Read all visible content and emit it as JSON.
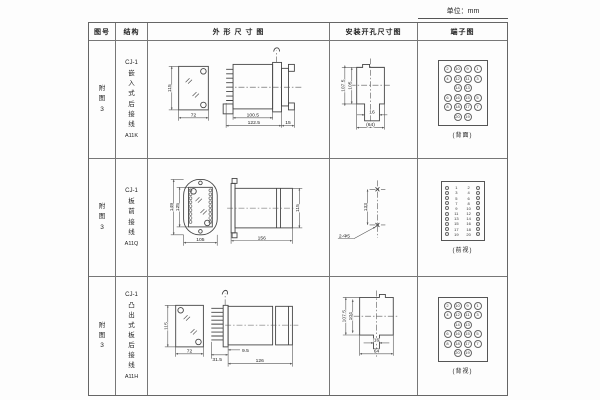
{
  "page": {
    "unit_label": "单位：mm"
  },
  "table": {
    "headers": [
      "图号",
      "结构",
      "外 形 尺 寸 图",
      "安装开孔尺寸图",
      "端子图"
    ]
  },
  "rows": [
    {
      "fig_no": "附图3",
      "structure": {
        "model": "CJ-1",
        "mount": "嵌入式后接线",
        "code": "A11K"
      },
      "outline": {
        "front_height": "115",
        "front_width": "72",
        "body_depth": "100.5",
        "total_depth": "122.5",
        "rear_depth": "15"
      },
      "mounting": {
        "outer_height": "107.5",
        "inner_height": "105",
        "slot_width": "16",
        "overall_width": "(64)"
      },
      "terminal": {
        "caption": "(背面)",
        "grid": [
          [
            "2",
            "10",
            "9",
            "1"
          ],
          [
            "4",
            "12",
            "11",
            "3"
          ],
          [
            "",
            "14",
            "13",
            ""
          ],
          [
            "6",
            "16",
            "15",
            "5"
          ],
          [
            "8",
            "18",
            "17",
            "7"
          ],
          [
            "",
            "20",
            "19",
            ""
          ]
        ]
      }
    },
    {
      "fig_no": "附图3",
      "structure": {
        "model": "CJ-1",
        "mount": "板前接线",
        "code": "A11Q"
      },
      "outline": {
        "front_outer_height": "149",
        "front_inner_height": "125",
        "front_width": "105",
        "depth": "156",
        "side_height": "115"
      },
      "mounting": {
        "hole_spacing": "133",
        "holes_label": "2-Φ5"
      },
      "terminal": {
        "caption": "(前视)",
        "strip": [
          [
            "1",
            "2"
          ],
          [
            "3",
            "4"
          ],
          [
            "5",
            "6"
          ],
          [
            "7",
            "8"
          ],
          [
            "9",
            "10"
          ],
          [
            "11",
            "12"
          ],
          [
            "13",
            "14"
          ],
          [
            "15",
            "16"
          ],
          [
            "17",
            "18"
          ],
          [
            "19",
            "20"
          ]
        ]
      }
    },
    {
      "fig_no": "附图3",
      "structure": {
        "model": "CJ-1",
        "mount": "凸出式板后接线",
        "code": "A11H"
      },
      "outline": {
        "front_height": "115",
        "front_width": "72",
        "pin_depth": "31.5",
        "flange_depth": "9.5",
        "body_depth": "126"
      },
      "mounting": {
        "outer_height": "107.5",
        "inner_height": "104",
        "tab_width": "16",
        "overall_width": "64"
      },
      "terminal": {
        "caption": "(背视)",
        "grid": [
          [
            "2",
            "10",
            "9",
            "1"
          ],
          [
            "4",
            "12",
            "11",
            "3"
          ],
          [
            "",
            "14",
            "13",
            ""
          ],
          [
            "6",
            "16",
            "15",
            "5"
          ],
          [
            "8",
            "18",
            "17",
            "7"
          ],
          [
            "",
            "20",
            "19",
            ""
          ]
        ]
      }
    }
  ]
}
